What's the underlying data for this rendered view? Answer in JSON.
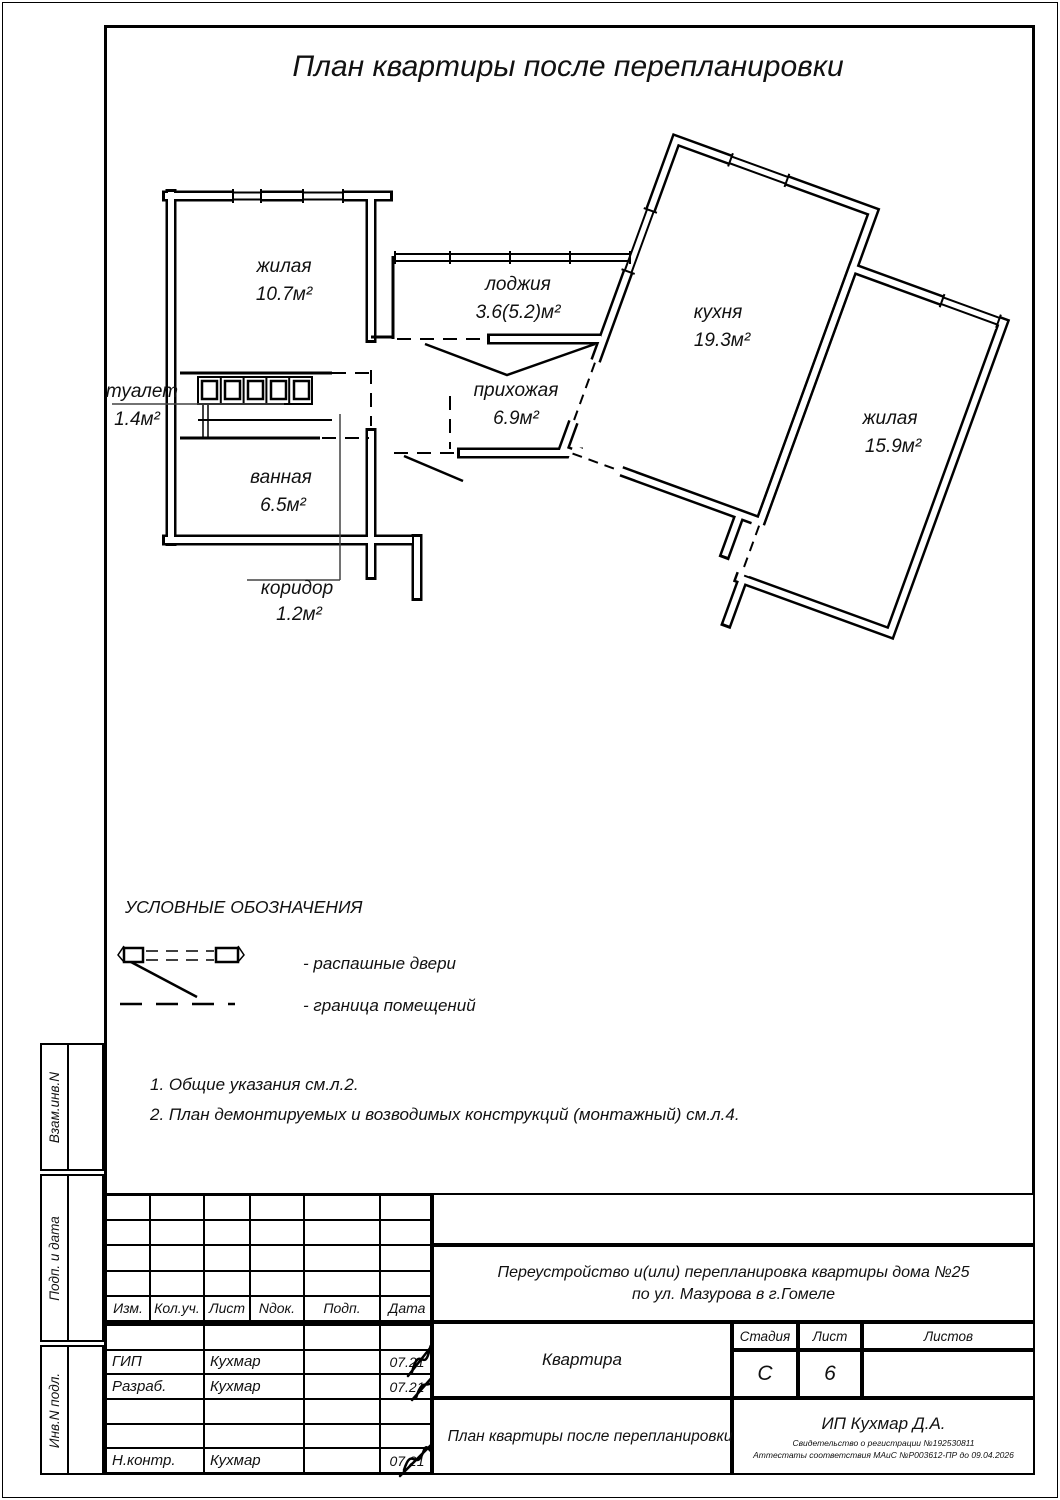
{
  "sheet": {
    "title": "План квартиры после перепланировки"
  },
  "plan": {
    "rooms": [
      {
        "name": "жилая",
        "area": "10.7м²"
      },
      {
        "name": "лоджия",
        "area": "3.6(5.2)м²"
      },
      {
        "name": "прихожая",
        "area": "6.9м²"
      },
      {
        "name": "кухня",
        "area": "19.3м²"
      },
      {
        "name": "жилая",
        "area": "15.9м²"
      },
      {
        "name": "туалет",
        "area": "1.4м²"
      },
      {
        "name": "ванная",
        "area": "6.5м²"
      },
      {
        "name": "коридор",
        "area": "1.2м²"
      }
    ]
  },
  "legend": {
    "title": "УСЛОВНЫЕ ОБОЗНАЧЕНИЯ",
    "items": [
      {
        "label": "- распашные двери"
      },
      {
        "label": "- граница помещений"
      }
    ]
  },
  "notes": [
    "1. Общие указания см.л.2.",
    "2. План демонтируемых и возводимых конструкций (монтажный) см.л.4."
  ],
  "title_block": {
    "columns": [
      "Изм.",
      "Кол.уч.",
      "Лист",
      "Nдок.",
      "Подп.",
      "Дата"
    ],
    "rows": [
      {
        "role": "ГИП",
        "name": "Кухмар",
        "date": "07.21"
      },
      {
        "role": "Разраб.",
        "name": "Кухмар",
        "date": "07.21"
      },
      {
        "role": "Н.контр.",
        "name": "Кухмар",
        "date": "07.21"
      }
    ],
    "project_line1": "Переустройство и(или) перепланировка квартиры дома №25",
    "project_line2": "по ул. Мазурова в г.Гомеле",
    "object": "Квартира",
    "stage_label": "Стадия",
    "stage": "С",
    "sheet_label": "Лист",
    "sheet_no": "6",
    "sheets_label": "Листов",
    "drawing_title": "План квартиры после перепланировки",
    "company": "ИП Кухмар Д.А.",
    "certificate": "Свидетельство о регистрации №192530811",
    "attestation": "Аттестаты соответствия МАиС №Р003612-ПР до 09.04.2026"
  },
  "sidebar": {
    "labels": [
      "Взам.инв.N",
      "Подп. и дата",
      "Инв.N подл."
    ]
  },
  "colors": {
    "line": "#000000",
    "paper": "#ffffff"
  }
}
